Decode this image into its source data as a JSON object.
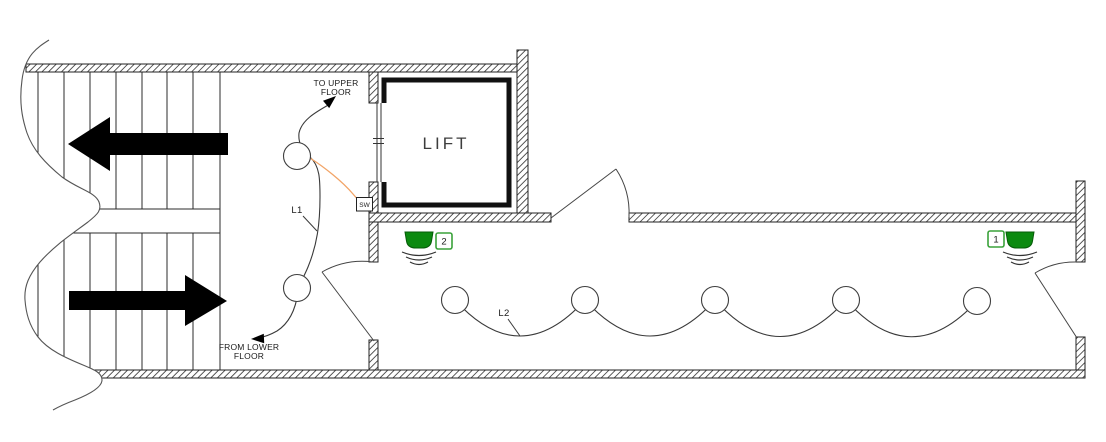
{
  "plan": {
    "room_label": "LIFT",
    "annotations": {
      "to_upper": {
        "line1": "TO UPPER",
        "line2": "FLOOR"
      },
      "from_lower": {
        "line1": "FROM LOWER",
        "line2": "FLOOR"
      }
    },
    "switch_label": "SW",
    "circuits": {
      "l1": {
        "label": "L1",
        "light_radius": 13.5,
        "lights": [
          {
            "x": 297,
            "y": 156
          },
          {
            "x": 297,
            "y": 288
          }
        ]
      },
      "l2": {
        "label": "L2",
        "light_radius": 13.5,
        "lights": [
          {
            "x": 455,
            "y": 300
          },
          {
            "x": 585,
            "y": 300
          },
          {
            "x": 715,
            "y": 300
          },
          {
            "x": 846,
            "y": 300
          },
          {
            "x": 977,
            "y": 301
          }
        ]
      }
    },
    "sensors": [
      {
        "id": "2",
        "dome_x": 419,
        "dome_y": 240,
        "plate_x": 444,
        "plate_y": 241
      },
      {
        "id": "1",
        "dome_x": 1020,
        "dome_y": 240,
        "plate_x": 996,
        "plate_y": 239
      }
    ],
    "colors": {
      "sensor_green": "#0c8a10",
      "sensor_green_border": "#065c08",
      "plate_green": "#3aa23a",
      "plate_text_green": "#1f8a1f",
      "wire_orange": "#f2a467",
      "ink": "#1f1f1f"
    }
  }
}
